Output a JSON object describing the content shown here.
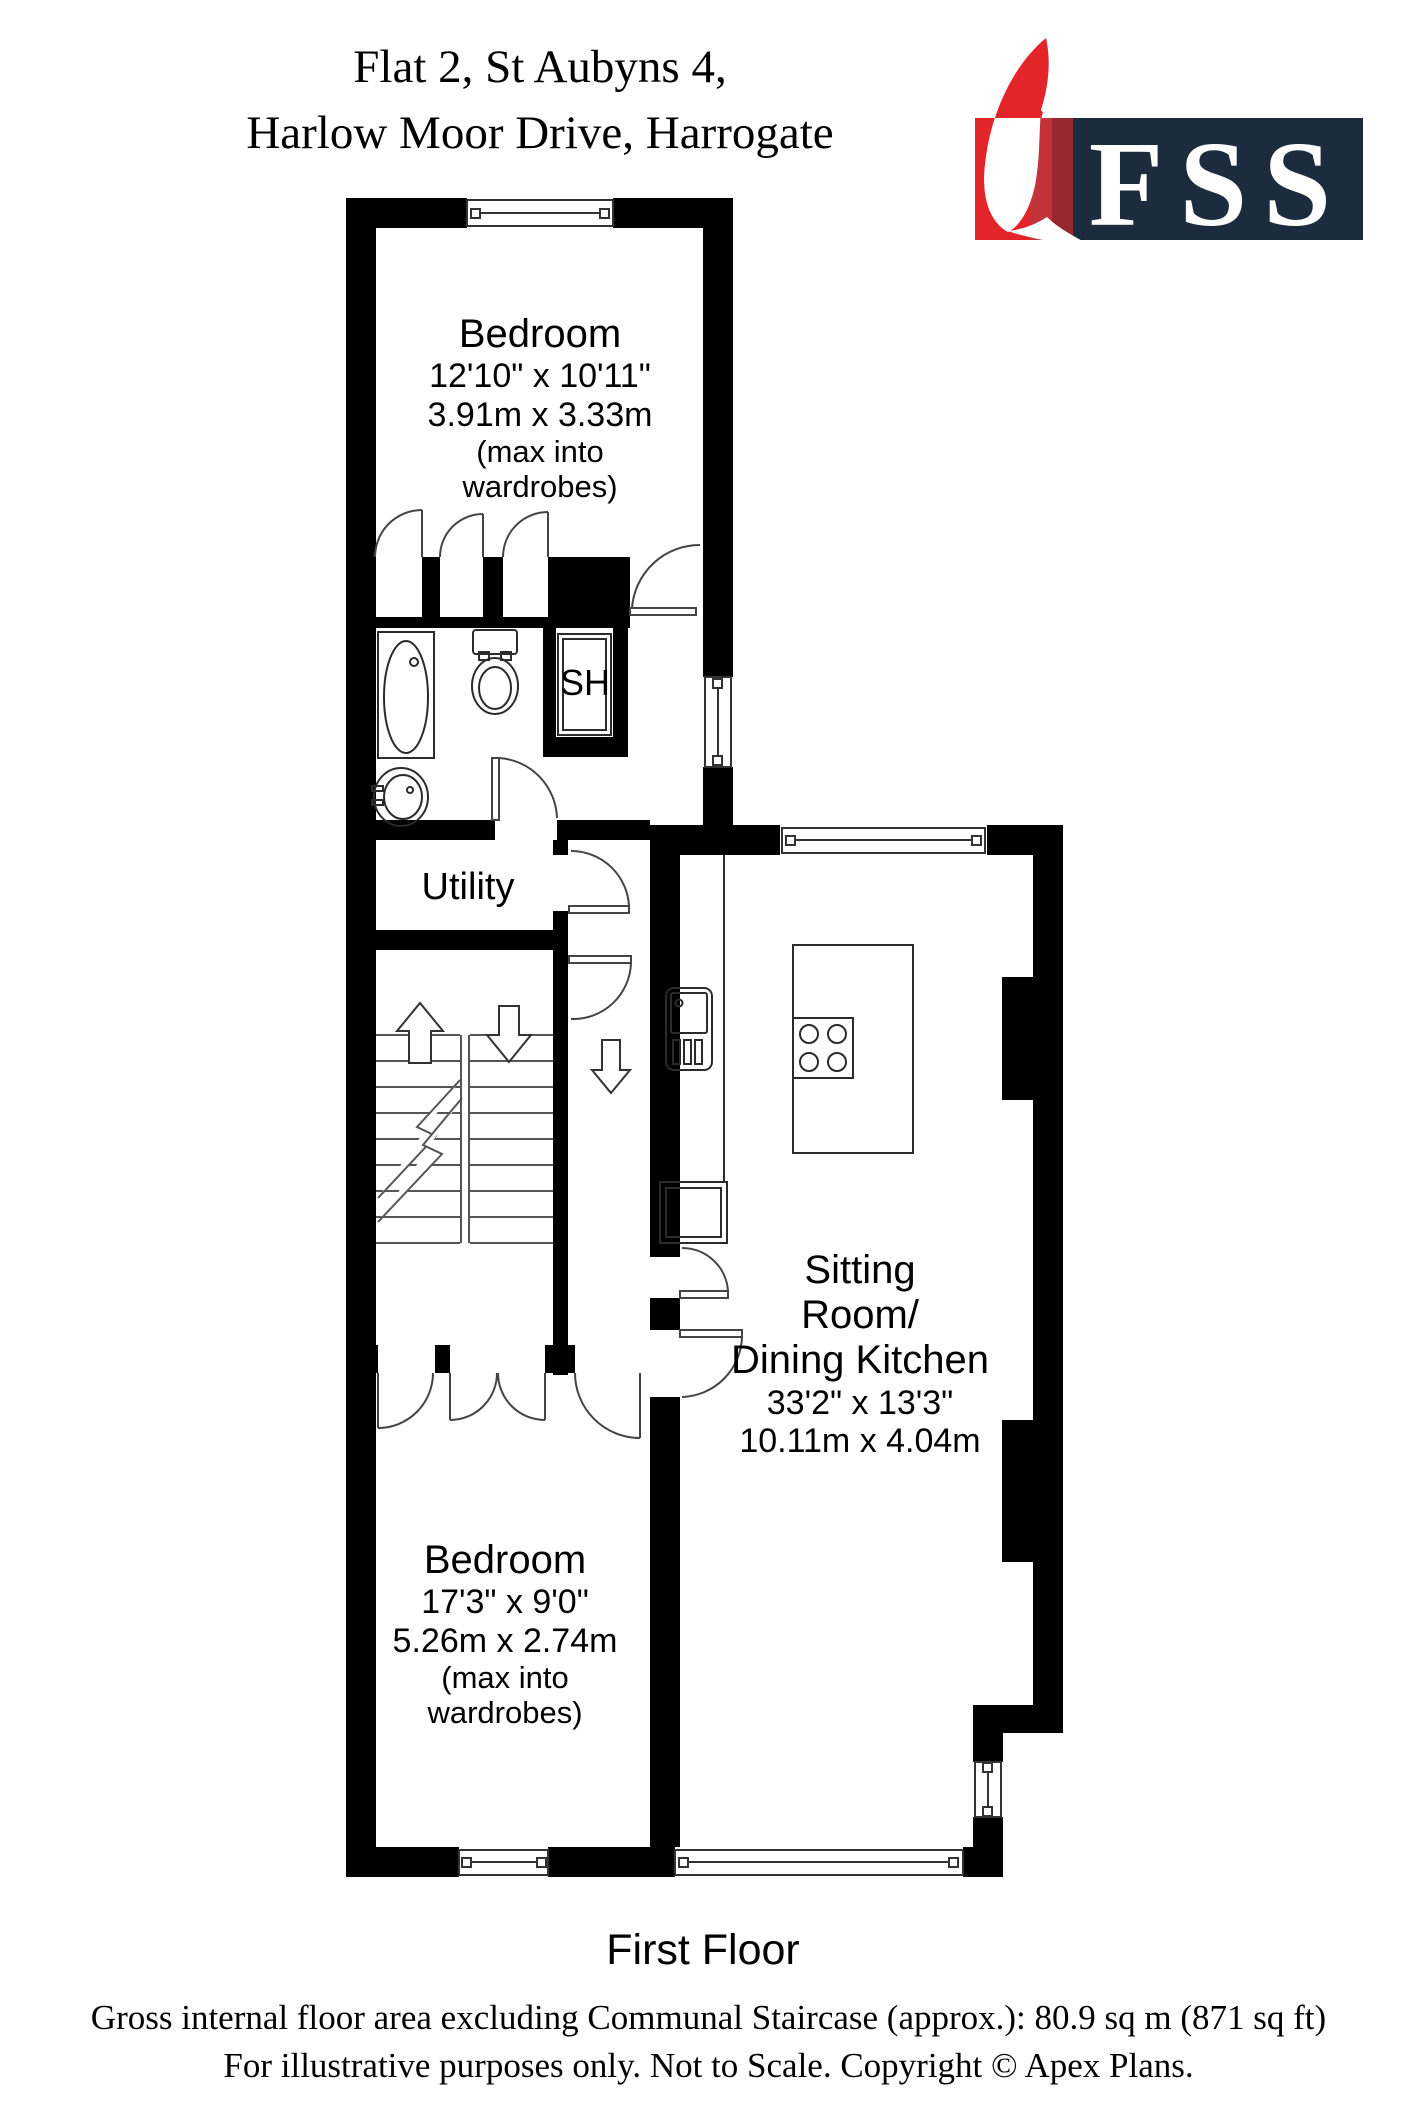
{
  "header": {
    "address_line1": "Flat 2, St Aubyns 4,",
    "address_line2": "Harlow Moor Drive, Harrogate"
  },
  "logo": {
    "text": "FSS",
    "icon": "feather-icon",
    "colors": {
      "red": "#e3252a",
      "red_mid": "#c23439",
      "red_dark": "#97282e",
      "navy": "#1c2b3d"
    }
  },
  "plan": {
    "wall_color": "#000000",
    "rooms": {
      "bedroom1": {
        "name": "Bedroom",
        "imperial": "12'10\" x 10'11\"",
        "metric": "3.91m x 3.33m",
        "note1": "(max into",
        "note2": "wardrobes)"
      },
      "sitting": {
        "name1": "Sitting",
        "name2": "Room/",
        "name3": "Dining Kitchen",
        "imperial": "33'2\" x 13'3\"",
        "metric": "10.11m x 4.04m"
      },
      "bedroom2": {
        "name": "Bedroom",
        "imperial": "17'3\" x 9'0\"",
        "metric": "5.26m x 2.74m",
        "note1": "(max into",
        "note2": "wardrobes)"
      }
    },
    "labels": {
      "shower": "SH",
      "utility": "Utility"
    }
  },
  "footer": {
    "floor_label": "First Floor",
    "area_line": "Gross internal floor area excluding Communal Staircase (approx.): 80.9 sq m (871 sq ft)",
    "disclaimer": "For illustrative purposes only. Not to Scale. Copyright © Apex Plans."
  }
}
